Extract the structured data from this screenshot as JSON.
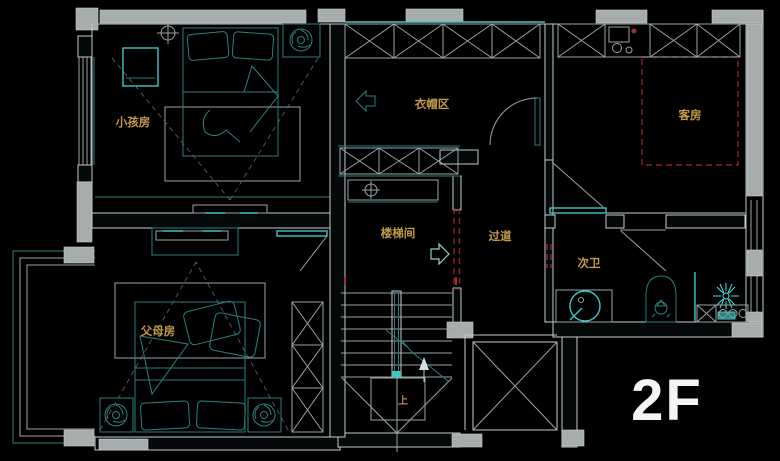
{
  "floor": {
    "label": "2F"
  },
  "rooms": {
    "kids_room": {
      "label": "小孩房"
    },
    "cloak_area": {
      "label": "衣帽区"
    },
    "guest_room": {
      "label": "客房"
    },
    "stairwell": {
      "label": "楼梯间"
    },
    "corridor": {
      "label": "过道"
    },
    "second_bath": {
      "label": "次卫"
    },
    "parents_room": {
      "label": "父母房"
    }
  },
  "stairs": {
    "direction_label": "上"
  },
  "icons": {
    "spiral_fan": "exhaust-fan-spiral",
    "ceiling_fan": "crosshair-ceiling-fan",
    "shower": "starburst-shower-head",
    "arrow_left": "entry-arrow-left",
    "arrow_right": "entry-arrow-right",
    "arrow_up": "stairs-up-arrow"
  },
  "palette": {
    "background": "#000000",
    "wall_fill_gray": "#a7acac",
    "line_white": "#c6cccc",
    "furniture_teal": "#2c8181",
    "furniture_bright_teal": "#3fc6c6",
    "label_yellow": "#c59a4a",
    "dashed_red": "#8a2424",
    "floor_label_white": "#f4f4f4"
  }
}
